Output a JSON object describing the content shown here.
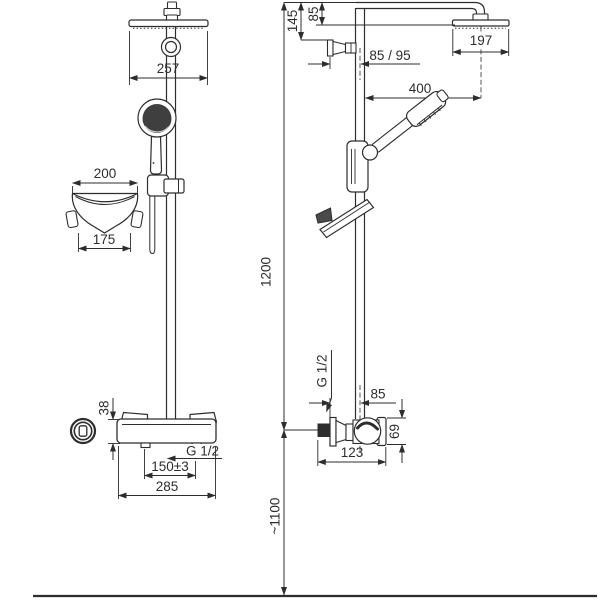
{
  "colors": {
    "line": "#2d2d2d",
    "background": "#ffffff",
    "dark_fill": "#3f3f3f"
  },
  "front_view": {
    "dims": {
      "head_width": "257",
      "dish_top_width": "200",
      "dish_bottom_width": "175",
      "body_height": "38",
      "thread_label": "G 1/2",
      "inlet_spacing": "150±3",
      "body_width": "285"
    }
  },
  "side_view": {
    "dims": {
      "arm_drop": "145",
      "head_drop": "85",
      "head_depth": "197",
      "wall_clearance": "85 / 95",
      "arm_reach": "400",
      "column_height": "1200",
      "thread_label": "G 1/2",
      "wall_to_center": "85",
      "valve_height": "69",
      "valve_depth": "123",
      "valve_to_floor": "~1100"
    }
  }
}
